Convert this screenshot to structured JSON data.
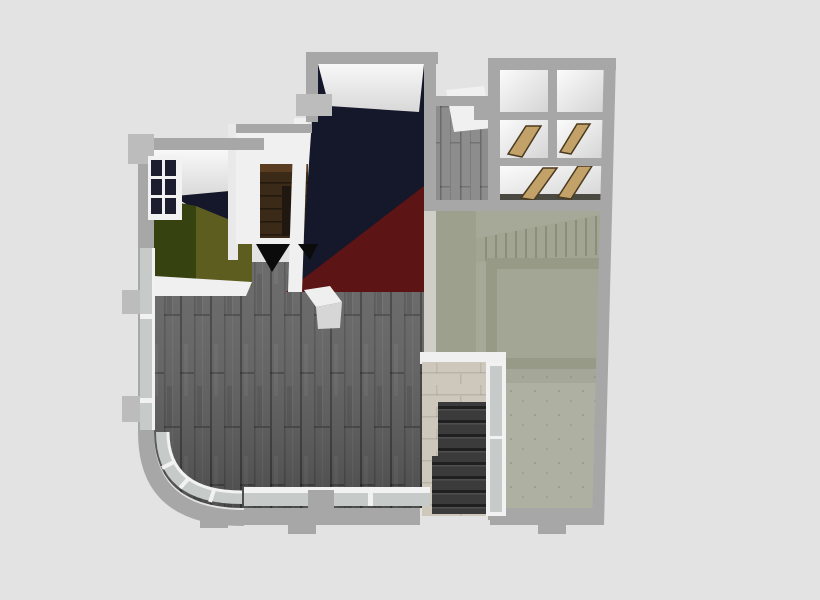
{
  "scene": {
    "name": "floor-plan-3d-render",
    "description": "Overhead 3D architectural rendering of an apartment floor plan on a plain light-gray background",
    "rooms": [
      {
        "name": "main-living-area",
        "floor": "dark gray wood planks",
        "color_key": "wood_floor"
      },
      {
        "name": "green-bedroom",
        "floor": "two-tone green carpet",
        "color_key": "green_dark"
      },
      {
        "name": "closet-room",
        "floor": "brown wood",
        "color_key": "closet_floor"
      },
      {
        "name": "dark-media-room",
        "floor": "navy with red carpet corner",
        "color_key": "navy"
      },
      {
        "name": "upper-hallway",
        "floor": "light gray wood",
        "color_key": "wood_floor_light"
      },
      {
        "name": "stair-grid-block",
        "floor": "white cells with wood hatches",
        "color_key": "surface_white"
      },
      {
        "name": "sage-utility-room",
        "floor": "sage concrete",
        "color_key": "sage"
      },
      {
        "name": "stone-stair-enclosure",
        "floor": "beige stone with dark basement stairs",
        "color_key": "beige_stone"
      }
    ]
  },
  "colors": {
    "background": "#e3e3e3",
    "wall": "#a7a7a7",
    "wall_light": "#bcbcbc",
    "surface_white": "#f0f0f0",
    "ceiling_white": "#e9e9e9",
    "hall_white": "#ededed",
    "navy": "#15172a",
    "navy_pane": "#1c1d2e",
    "maroon": "#5c1414",
    "green_dark": "#36420f",
    "green_moss": "#5c5d1f",
    "wood_floor": "#5f5f5f",
    "wood_floor_light": "#8d8d8d",
    "sage": "#a6a997",
    "sage_col": "#9da08c",
    "sage_wall": "#969a86",
    "sage_mid": "#a3a694",
    "sage_inner": "#aeb0a1",
    "sage_stairs": "#a2a591",
    "tan_wood": "#c2a268",
    "brown_wood": "#5a3c21",
    "closet_floor": "#3a2a17",
    "ladder_dark": "#201711",
    "beige_stone": "#cdc8bb",
    "stair_dark": "#3b3b3b",
    "glass": "#c6cac9",
    "glass_frame": "#f2f2f2",
    "black_opening": "#0b0b0b",
    "cube_top": "#efefef",
    "cube_side": "#d6d6d6",
    "white_strip": "#cfcfc8",
    "grid_dark_band": "#4a4a42"
  }
}
